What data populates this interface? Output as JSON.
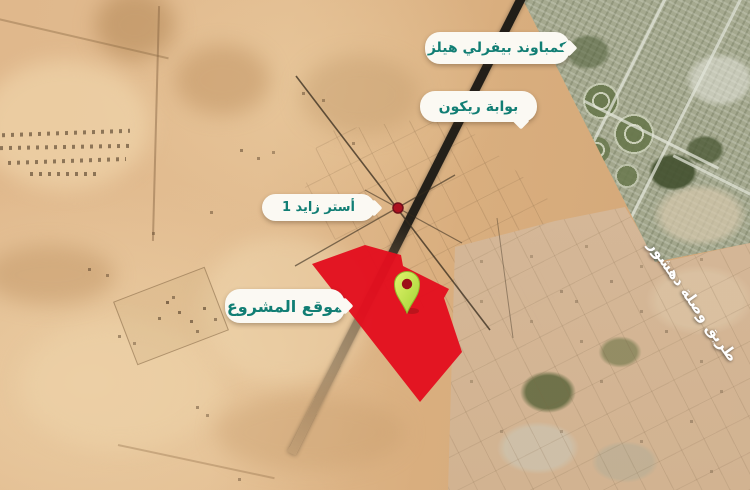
{
  "map": {
    "description": "satellite-map-graphic",
    "labels": {
      "compound": "كمباوند بيفرلي هيلز",
      "gate": "بوابة ريكون",
      "zayed": "أستر زايد 1",
      "project": "موقع المشروع",
      "road": "طريق وصلة دهشور"
    },
    "colors": {
      "label_text": "#117e74",
      "label_bg": "#fbf9f3",
      "site_polygon": "#e30f1e",
      "junction_dot": "#ad1120",
      "pin_light": "#e2f46d",
      "pin_dark": "#a2d335",
      "pin_hole": "#9c1018",
      "road": "#24211b"
    }
  }
}
